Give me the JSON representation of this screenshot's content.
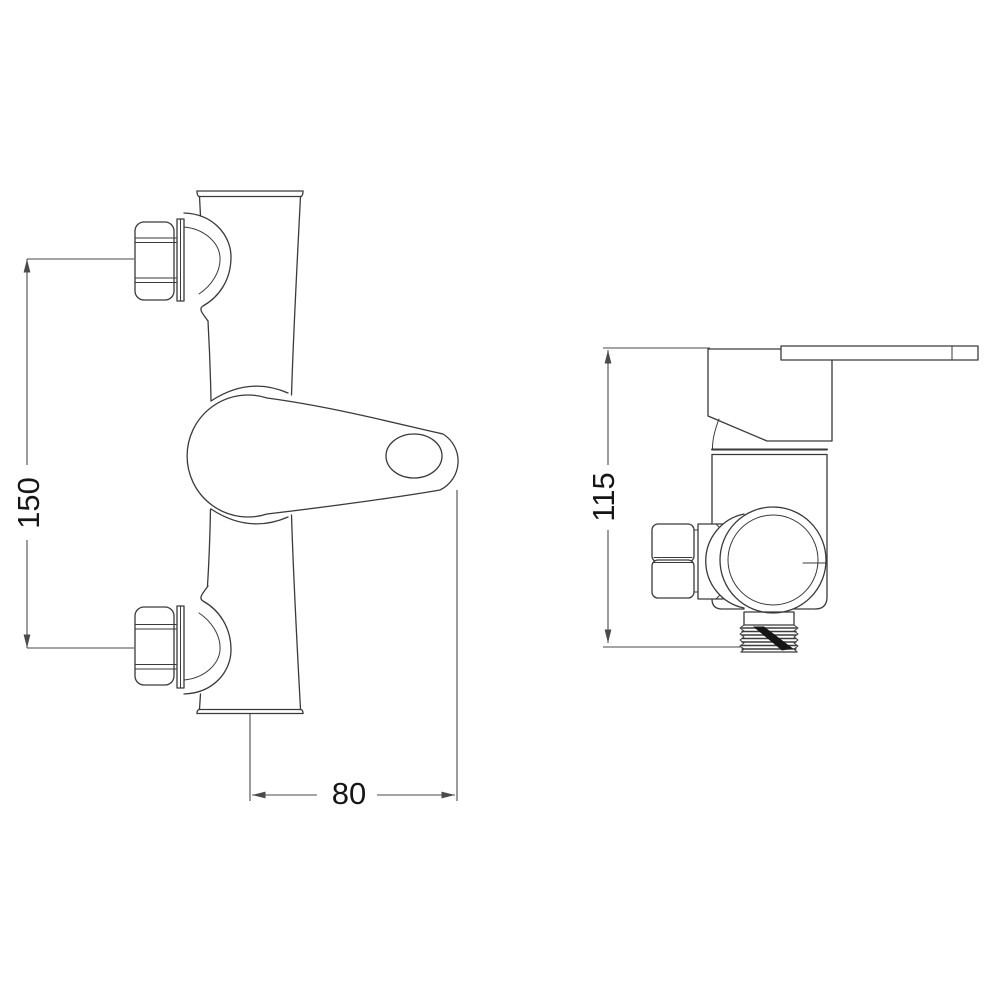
{
  "drawing": {
    "background": "#ffffff",
    "line_color": "#3a3a3a",
    "dim_color": "#4a4a4a",
    "subject": "wall-mounted shower mixer valve technical drawing",
    "views": {
      "front": "front elevation",
      "side": "side elevation"
    },
    "dimensions": {
      "height": {
        "label": "150"
      },
      "width": {
        "label": "80"
      },
      "depth": {
        "label": "115"
      }
    }
  }
}
